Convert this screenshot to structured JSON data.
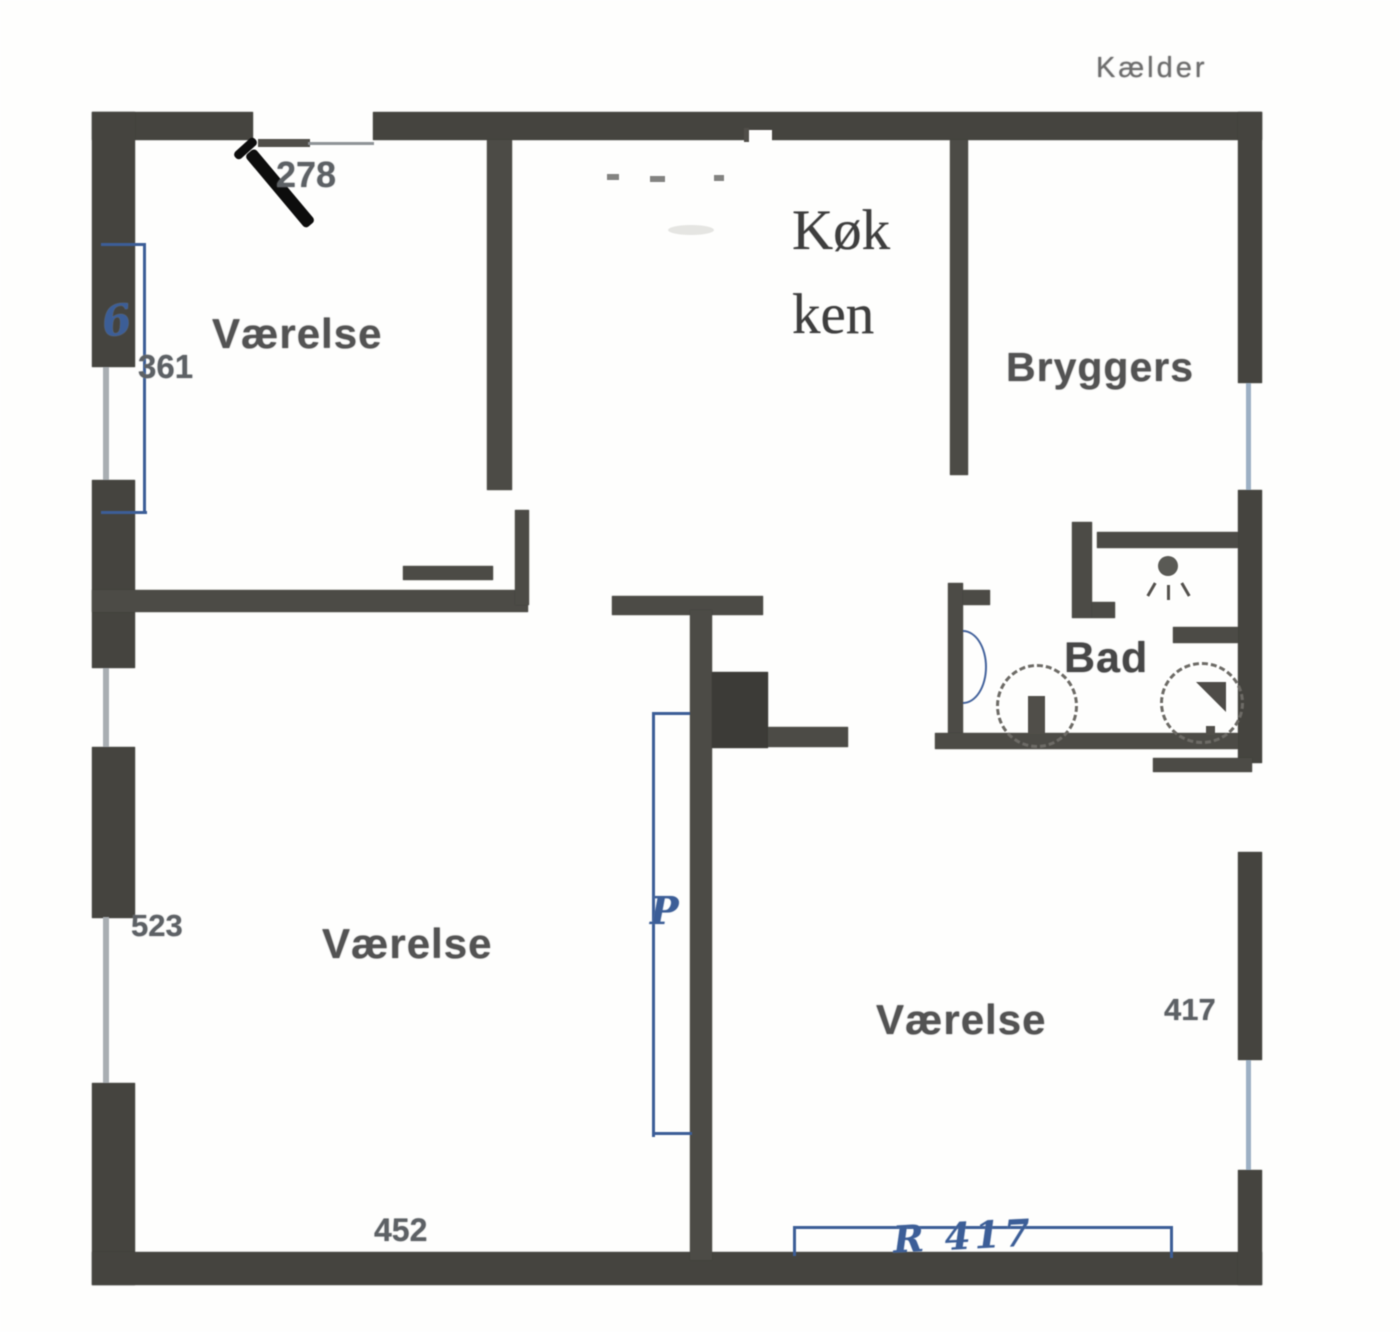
{
  "document": {
    "title": "Kælder"
  },
  "rooms": {
    "room_nw": "Værelse",
    "kitchen_line1": "Køk",
    "kitchen_line2": "ken",
    "bryggers": "Bryggers",
    "bad": "Bad",
    "room_sw": "Værelse",
    "room_se": "Værelse"
  },
  "dimensions": {
    "door_top": "278",
    "window_nw": "361",
    "wall_sw": "523",
    "wall_bottom_sw": "452",
    "window_se": "417"
  },
  "pen_annotations": {
    "mark_window_nw": "6",
    "mark_center": "P",
    "mark_bottom_se": "R 417"
  },
  "colors": {
    "wall": "#45443f",
    "pen_blue": "#3c5e97",
    "pen_black": "#0d0d0d",
    "label_gray": "#535353",
    "window_line": "#a9aeb2"
  }
}
